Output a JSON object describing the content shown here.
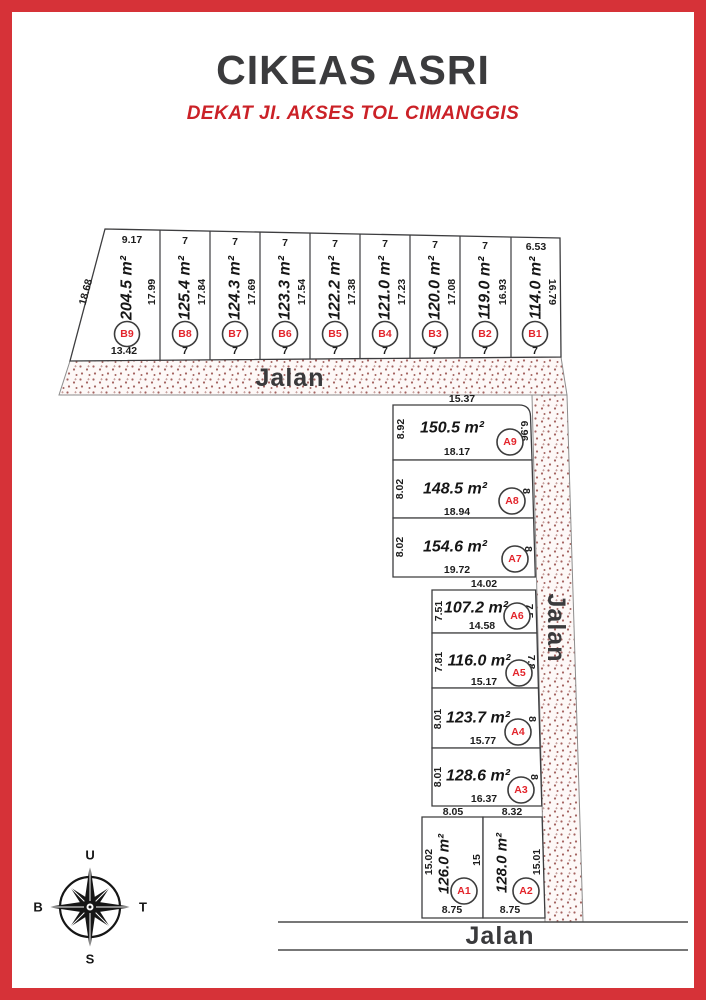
{
  "page": {
    "title": "CIKEAS ASRI",
    "subtitle": "DEKAT JI. AKSES TOL CIMANGGIS"
  },
  "roads": {
    "top_label": "Jalan",
    "right_label": "Jalan",
    "bottom_label": "Jalan"
  },
  "compass": {
    "north": "U",
    "south": "S",
    "west": "B",
    "east": "T"
  },
  "colors": {
    "frame_red": "#d63238",
    "plot_label_red": "#e3242b",
    "subtitle_red": "#cb2127",
    "title_gray": "#3b3b3d",
    "stipple_dot": "#a4625f",
    "stipple_bg": "#fdf8f7"
  },
  "plots_b": [
    {
      "id": "B9",
      "area": "204.5 m²",
      "top": "9.17",
      "left": "18.68",
      "right": "17.99",
      "bottom": "13.42"
    },
    {
      "id": "B8",
      "area": "125.4 m²",
      "top": "7",
      "right": "17.84",
      "bottom": "7"
    },
    {
      "id": "B7",
      "area": "124.3 m²",
      "top": "7",
      "right": "17.69",
      "bottom": "7"
    },
    {
      "id": "B6",
      "area": "123.3 m²",
      "top": "7",
      "right": "17.54",
      "bottom": "7"
    },
    {
      "id": "B5",
      "area": "122.2 m²",
      "top": "7",
      "right": "17.38",
      "bottom": "7"
    },
    {
      "id": "B4",
      "area": "121.0 m²",
      "top": "7",
      "right": "17.23",
      "bottom": "7"
    },
    {
      "id": "B3",
      "area": "120.0 m²",
      "top": "7",
      "right": "17.08",
      "bottom": "7"
    },
    {
      "id": "B2",
      "area": "119.0 m²",
      "top": "7",
      "right": "16.93",
      "bottom": "7"
    },
    {
      "id": "B1",
      "area": "114.0 m²",
      "top": "6.53",
      "right": "16.79",
      "bottom": "7"
    }
  ],
  "plots_a": [
    {
      "id": "A9",
      "area": "150.5 m²",
      "top": "15.37",
      "left": "8.92",
      "right": "6.96",
      "bottom": "18.17"
    },
    {
      "id": "A8",
      "area": "148.5 m²",
      "left": "8.02",
      "right": "8",
      "bottom": "18.94"
    },
    {
      "id": "A7",
      "area": "154.6 m²",
      "left": "8.02",
      "right": "8",
      "bottom": "19.72"
    },
    {
      "id": "A6",
      "area": "107.2 m²",
      "top": "14.02",
      "left": "7.51",
      "right": "7.5",
      "bottom": "14.58"
    },
    {
      "id": "A5",
      "area": "116.0 m²",
      "left": "7.81",
      "right": "7.8",
      "bottom": "15.17"
    },
    {
      "id": "A4",
      "area": "123.7 m²",
      "left": "8.01",
      "right": "8",
      "bottom": "15.77"
    },
    {
      "id": "A3",
      "area": "128.6 m²",
      "left": "8.01",
      "right": "8",
      "bottom": "16.37"
    },
    {
      "id": "A1",
      "area": "126.0 m²",
      "top": "8.05",
      "left": "15.02",
      "right": "15",
      "bottom": "8.75"
    },
    {
      "id": "A2",
      "area": "128.0 m²",
      "top": "8.32",
      "right": "15.01",
      "bottom": "8.75"
    }
  ]
}
